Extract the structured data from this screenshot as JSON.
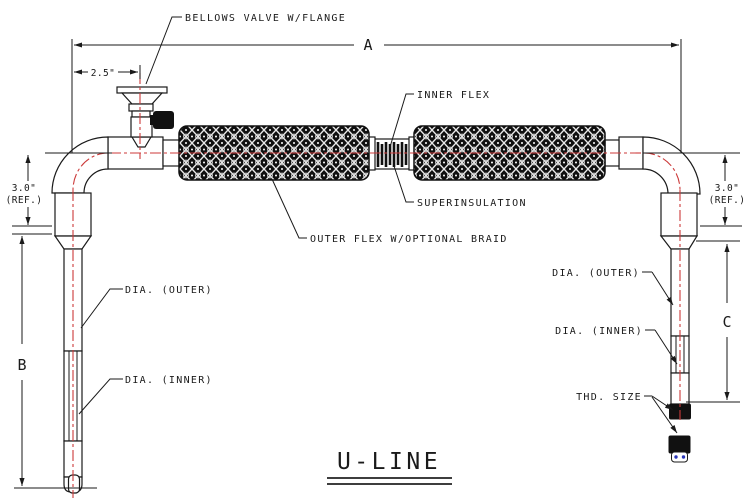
{
  "drawing": {
    "title": "U-LINE",
    "labels": {
      "bellows_valve": "BELLOWS VALVE W/FLANGE",
      "inner_flex": "INNER FLEX",
      "superinsulation": "SUPERINSULATION",
      "outer_flex": "OUTER FLEX W/OPTIONAL BRAID",
      "dia_outer": "DIA. (OUTER)",
      "dia_inner": "DIA. (INNER)",
      "thd_size": "THD. SIZE"
    },
    "dims": {
      "a": "A",
      "b": "B",
      "c": "C",
      "valve_offset": "2.5\"",
      "elbow_ref": "3.0\"",
      "ref_suffix": "(REF.)"
    },
    "colors": {
      "line": "#1a1a1a",
      "centerline": "#cc3a3a",
      "braid": "#101010",
      "thread_accent": "#2a35b8"
    }
  }
}
